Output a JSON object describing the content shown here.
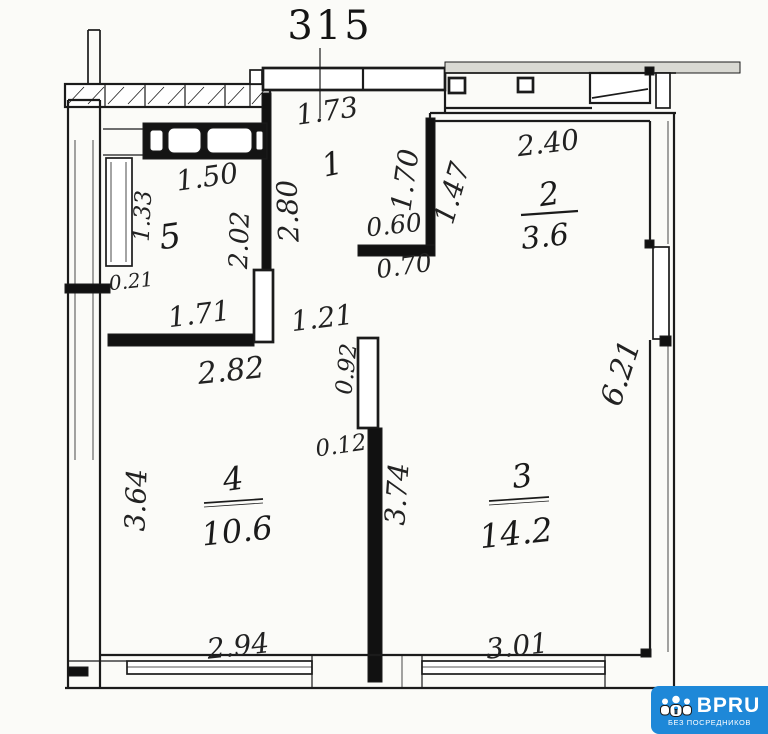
{
  "plan": {
    "title": "315",
    "rooms": {
      "room1": {
        "number": "1"
      },
      "room2": {
        "number": "2",
        "area": "3.6"
      },
      "room3": {
        "number": "3",
        "area": "14.2"
      },
      "room4": {
        "number": "4",
        "area": "10.6"
      },
      "room5": {
        "number": "5"
      }
    },
    "dimensions": {
      "hall_top": "1.73",
      "hall_left": "2.80",
      "hall_right": "1.70",
      "room2_left": "1.47",
      "niche_top": "0.60",
      "niche_bottom": "0.70",
      "room2_top": "2.40",
      "bath_top": "1.50",
      "bath_left": "1.33",
      "bath_offset": "0.21",
      "bath_right": "2.02",
      "bath_bottom": "1.71",
      "bath_wall_bottom": "2.82",
      "opening_width": "1.21",
      "door_opening": "0.92",
      "wall_gap": "0.12",
      "room4_left": "3.64",
      "room4_bottom": "2.94",
      "partition_length": "3.74",
      "room3_bottom": "3.01",
      "right_side": "6.21"
    }
  },
  "colors": {
    "line": "#1b1b1b",
    "watermark_blue": "#1e88d8"
  },
  "watermark": {
    "brand": "BPRU",
    "tagline": "БЕЗ ПОСРЕДНИКОВ",
    "color": "#1e88d8"
  }
}
